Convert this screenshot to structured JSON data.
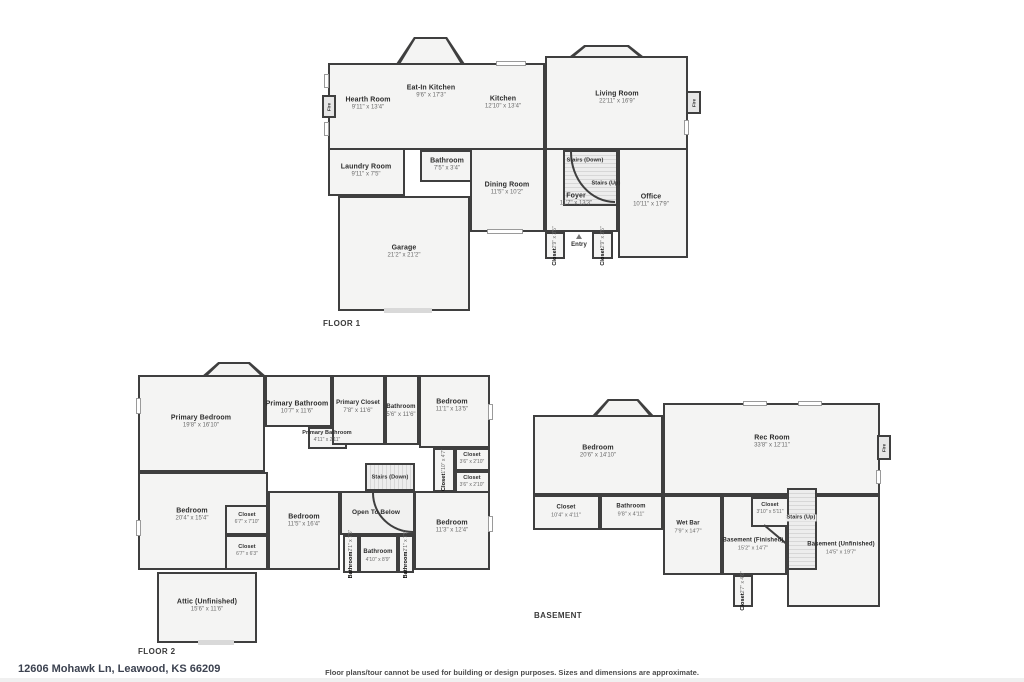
{
  "footer": {
    "address": "12606 Mohawk Ln, Leawood, KS 66209",
    "disclaimer": "Floor plans/tour cannot be used for building or design purposes. Sizes and dimensions are approximate."
  },
  "floor1": {
    "title": "FLOOR 1",
    "fire_label": "Fire",
    "rooms": {
      "hearth_room": {
        "name": "Hearth Room",
        "dims": "9'11\" x 13'4\""
      },
      "eat_in_kitchen": {
        "name": "Eat-In Kitchen",
        "dims": "9'6\" x 17'3\""
      },
      "kitchen": {
        "name": "Kitchen",
        "dims": "12'10\" x 13'4\""
      },
      "living_room": {
        "name": "Living Room",
        "dims": "22'11\" x 16'9\""
      },
      "laundry_room": {
        "name": "Laundry Room",
        "dims": "9'11\" x 7'5\""
      },
      "bathroom": {
        "name": "Bathroom",
        "dims": "7'5\" x 3'4\""
      },
      "dining_room": {
        "name": "Dining Room",
        "dims": "11'5\" x 10'2\""
      },
      "stairs_down": {
        "name": "Stairs (Down)"
      },
      "stairs_up": {
        "name": "Stairs (Up)"
      },
      "foyer": {
        "name": "Foyer",
        "dims": "11'7\" x 13'3\""
      },
      "office": {
        "name": "Office",
        "dims": "10'11\" x 17'9\""
      },
      "garage": {
        "name": "Garage",
        "dims": "21'2\" x 21'2\""
      },
      "closet_left": {
        "name": "Closet",
        "dims": "2'9\" x 3'5\""
      },
      "closet_right": {
        "name": "Closet",
        "dims": "2'9\" x 3'5\""
      },
      "entry": {
        "name": "Entry"
      }
    }
  },
  "floor2": {
    "title": "FLOOR 2",
    "rooms": {
      "primary_bedroom": {
        "name": "Primary Bedroom",
        "dims": "19'8\" x 16'10\""
      },
      "primary_bathroom": {
        "name": "Primary Bathroom",
        "dims": "10'7\" x 11'6\""
      },
      "primary_bathroom_small": {
        "name": "Primary Bathroom",
        "dims": "4'11\" x 2'11\""
      },
      "primary_closet": {
        "name": "Primary Closet",
        "dims": "7'8\" x 11'6\""
      },
      "bathroom_top": {
        "name": "Bathroom",
        "dims": "5'6\" x 11'6\""
      },
      "bedroom_ne": {
        "name": "Bedroom",
        "dims": "11'1\" x 13'5\""
      },
      "closet_side": {
        "name": "Closet",
        "dims": "1'10\" x 4'7\""
      },
      "closet_e1": {
        "name": "Closet",
        "dims": "3'6\" x 2'10\""
      },
      "closet_e2": {
        "name": "Closet",
        "dims": "3'6\" x 2'10\""
      },
      "stairs_down": {
        "name": "Stairs (Down)"
      },
      "open_to_below": {
        "name": "Open To Below"
      },
      "bedroom_w": {
        "name": "Bedroom",
        "dims": "20'4\" x 15'4\""
      },
      "closet_m1": {
        "name": "Closet",
        "dims": "6'7\" x 7'10\""
      },
      "closet_m2": {
        "name": "Closet",
        "dims": "6'7\" x 6'3\""
      },
      "bedroom_s": {
        "name": "Bedroom",
        "dims": "11'5\" x 16'4\""
      },
      "bathroom_left": {
        "name": "Bathroom",
        "dims": "2'1\" x 7'5\""
      },
      "bathroom_center": {
        "name": "Bathroom",
        "dims": "4'10\" x 8'9\""
      },
      "bathroom_right": {
        "name": "Bathroom",
        "dims": "2'1\" x 7'5\""
      },
      "bedroom_se": {
        "name": "Bedroom",
        "dims": "11'3\" x 12'4\""
      },
      "attic": {
        "name": "Attic (Unfinished)",
        "dims": "15'6\" x 11'6\""
      }
    }
  },
  "basement": {
    "title": "BASEMENT",
    "fire_label": "Fire",
    "rooms": {
      "bedroom": {
        "name": "Bedroom",
        "dims": "20'6\" x 14'10\""
      },
      "rec_room": {
        "name": "Rec Room",
        "dims": "33'8\" x 12'11\""
      },
      "closet_w": {
        "name": "Closet",
        "dims": "10'4\" x 4'11\""
      },
      "bathroom": {
        "name": "Bathroom",
        "dims": "9'8\" x 4'11\""
      },
      "wet_bar": {
        "name": "Wet Bar",
        "dims": "7'9\" x 14'7\""
      },
      "basement_finished": {
        "name": "Basement (Finished)",
        "dims": "15'2\" x 14'7\""
      },
      "closet_stairs": {
        "name": "Closet",
        "dims": "3'10\" x 5'11\""
      },
      "stairs_up": {
        "name": "Stairs (Up)"
      },
      "basement_unfinished": {
        "name": "Basement (Unfinished)",
        "dims": "14'5\" x 19'7\""
      },
      "closet_bottom": {
        "name": "Closet",
        "dims": "2'7\" x 4'6\""
      }
    }
  }
}
